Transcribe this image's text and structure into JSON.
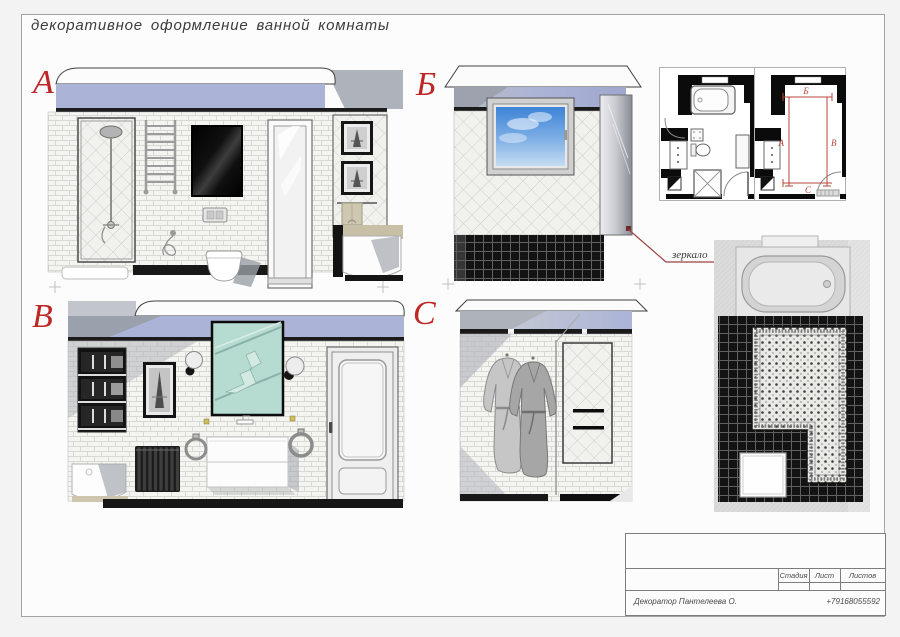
{
  "sheet": {
    "title": "декоративное оформление ванной комнаты"
  },
  "elevations": [
    {
      "id": "a",
      "label": "А"
    },
    {
      "id": "b",
      "label": "Б"
    },
    {
      "id": "v",
      "label": "В"
    },
    {
      "id": "c",
      "label": "С"
    }
  ],
  "key_plan": {
    "markers": {
      "top": "Б",
      "left": "А",
      "right": "В",
      "bottom": "С"
    }
  },
  "annotations": {
    "mirror_label": "зеркало"
  },
  "title_block": {
    "stage": "Стадия",
    "sheet": "Лист",
    "sheets": "Листов",
    "decorator": "Декоратор Пантелеева О.",
    "phone": "+79168055592"
  },
  "colors": {
    "accent_red": "#bf2626",
    "ceiling_blue": "#abb4d7",
    "mirror_mint": "#b6dbd1",
    "leader_maroon": "#9a4343",
    "tile_black": "#141414"
  }
}
